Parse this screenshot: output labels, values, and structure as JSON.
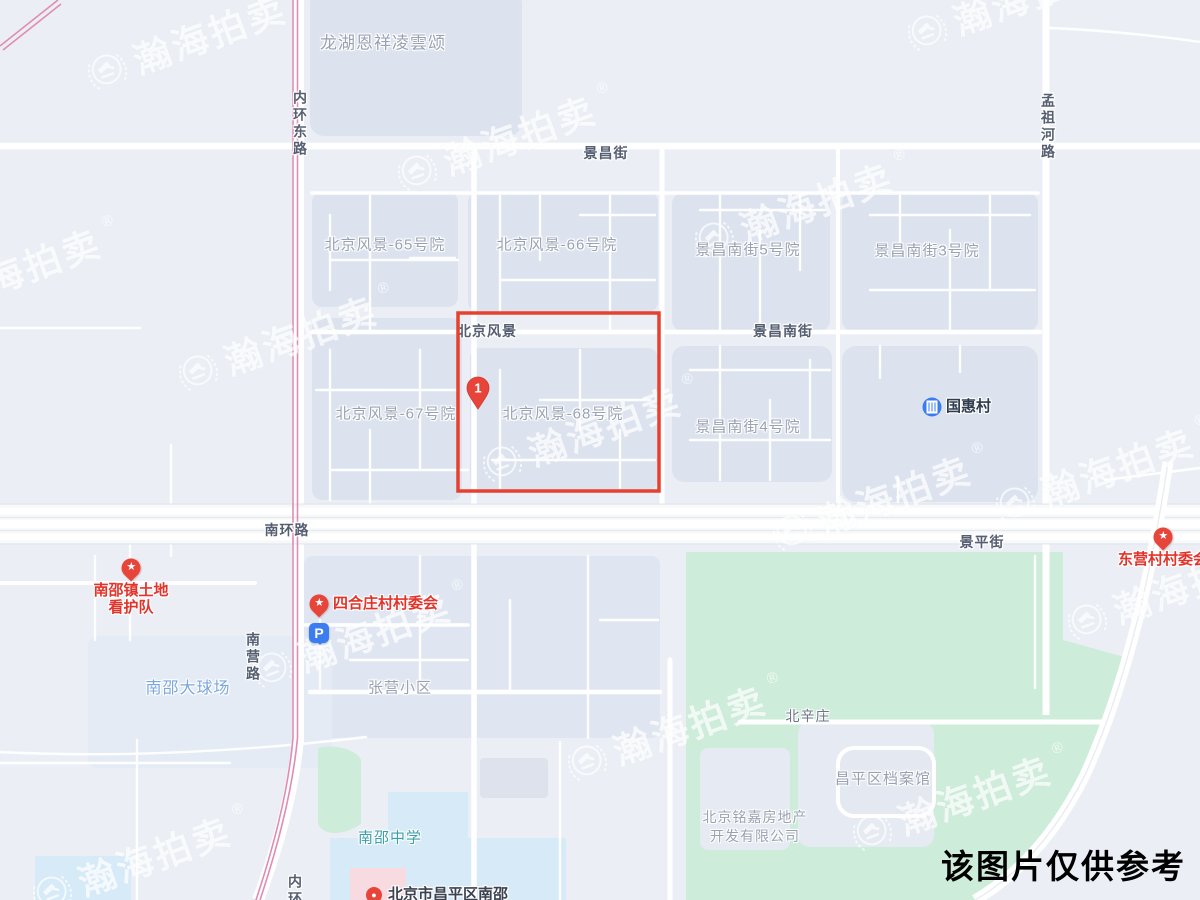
{
  "branding": {
    "watermark_text": "瀚海拍卖",
    "registered_mark": "®"
  },
  "disclaimer": "该图片仅供参考",
  "colors": {
    "highlight_red": "#e8402f",
    "poi_red": "#e2342b",
    "marker_red": "#e8453a",
    "parking_blue": "#3b7cf0",
    "railway_pink": "#e08cb4",
    "park_green": "#cdecd9",
    "campus_blue": "#d6eaf8",
    "block_fill": "#dce3ef"
  },
  "map": {
    "marker": {
      "label": "1",
      "x": 478,
      "y": 388
    },
    "highlight": {
      "x": 458,
      "y": 313,
      "w": 201,
      "h": 178
    },
    "road_labels": [
      {
        "name": "road-label-neihuandonglu",
        "text": "内环东路",
        "x": 300,
        "y": 90,
        "vertical": true
      },
      {
        "name": "road-label-jingchangjie",
        "text": "景昌街",
        "x": 606,
        "y": 153
      },
      {
        "name": "road-label-mengzuhelu",
        "text": "孟祖河路",
        "x": 1048,
        "y": 93,
        "vertical": true
      },
      {
        "name": "road-label-beijingfengjing",
        "text": "北京风景",
        "x": 487,
        "y": 331
      },
      {
        "name": "road-label-jingchangnanjie",
        "text": "景昌南街",
        "x": 783,
        "y": 331
      },
      {
        "name": "road-label-nanhuanlu",
        "text": "南环路",
        "x": 287,
        "y": 530
      },
      {
        "name": "road-label-jingpingjie",
        "text": "景平街",
        "x": 982,
        "y": 542
      },
      {
        "name": "road-label-nanyinglu",
        "text": "南营路",
        "x": 253,
        "y": 632,
        "vertical": true
      },
      {
        "name": "road-label-neihuan-south",
        "text": "内环",
        "x": 295,
        "y": 874,
        "vertical": true
      }
    ],
    "area_labels": [
      {
        "text": "龙湖恩祥凌雲颂",
        "x": 383,
        "y": 41,
        "size": 17
      },
      {
        "text": "北京风景-65号院",
        "x": 385,
        "y": 244
      },
      {
        "text": "北京风景-66号院",
        "x": 557,
        "y": 244
      },
      {
        "text": "景昌南街5号院",
        "x": 748,
        "y": 249
      },
      {
        "text": "景昌南街3号院",
        "x": 927,
        "y": 250
      },
      {
        "text": "北京风景-67号院",
        "x": 396,
        "y": 413
      },
      {
        "text": "北京风景-68号院",
        "x": 563,
        "y": 413
      },
      {
        "text": "景昌南街4号院",
        "x": 748,
        "y": 426
      },
      {
        "text": "张营小区",
        "x": 400,
        "y": 687
      },
      {
        "text": "北辛庄",
        "x": 808,
        "y": 716,
        "size": 14,
        "color": "#6d7584"
      },
      {
        "text": "昌平区档案馆",
        "x": 883,
        "y": 778
      },
      {
        "text": "北京铭嘉房地产",
        "x": 755,
        "y": 817,
        "size": 14
      },
      {
        "text": "开发有限公司",
        "x": 755,
        "y": 836,
        "size": 14
      },
      {
        "text": "南邵大球场",
        "x": 188,
        "y": 686,
        "size": 16,
        "color": "#7ba7dc"
      },
      {
        "text": "南邵中学",
        "x": 390,
        "y": 837,
        "color": "#3a9fa8"
      }
    ],
    "pois": [
      {
        "name": "poi-nanshao-land-patrol",
        "type": "star",
        "px": 131,
        "py": 568,
        "lines": [
          "南邵镇土地",
          "看护队"
        ],
        "layout": "below"
      },
      {
        "name": "poi-sihezhuang-committee",
        "type": "star",
        "px": 319,
        "py": 604,
        "lines": [
          "四合庄村村委会"
        ],
        "layout": "right"
      },
      {
        "name": "poi-parking",
        "type": "parking",
        "px": 319,
        "py": 633,
        "icon_letter": "P",
        "lines": [],
        "layout": "right"
      },
      {
        "name": "poi-dongying-committee",
        "type": "star",
        "px": 1163,
        "py": 537,
        "lines": [
          "东营村村委会"
        ],
        "layout": "below"
      },
      {
        "name": "poi-guohuicun",
        "type": "building",
        "px": 932,
        "py": 407,
        "lines": [
          "国惠村"
        ],
        "layout": "right",
        "color": "#2f3d4e"
      },
      {
        "name": "poi-nanshao-town",
        "type": "dot",
        "px": 374,
        "py": 895,
        "lines": [
          "北京市昌平区南邵"
        ],
        "layout": "right",
        "color": "#3a4150"
      }
    ]
  },
  "watermarks": [
    {
      "x": 105,
      "y": 66
    },
    {
      "x": 415,
      "y": 167
    },
    {
      "x": 925,
      "y": 27
    },
    {
      "x": -80,
      "y": 300
    },
    {
      "x": 196,
      "y": 367
    },
    {
      "x": 712,
      "y": 234
    },
    {
      "x": 500,
      "y": 458
    },
    {
      "x": 1013,
      "y": 499
    },
    {
      "x": 790,
      "y": 527
    },
    {
      "x": 270,
      "y": 664
    },
    {
      "x": 1085,
      "y": 616
    },
    {
      "x": 585,
      "y": 757
    },
    {
      "x": 870,
      "y": 827
    },
    {
      "x": 50,
      "y": 888
    }
  ]
}
